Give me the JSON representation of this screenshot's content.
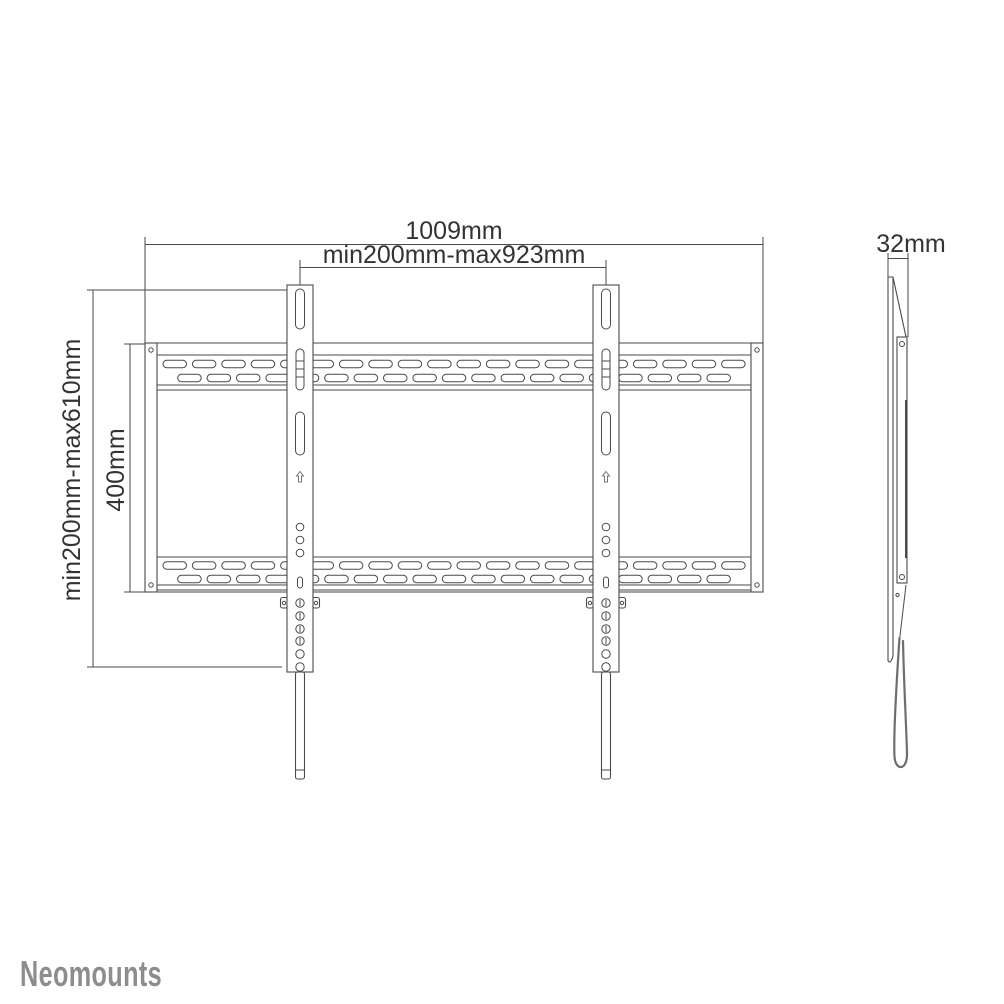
{
  "page": {
    "background": "#ffffff"
  },
  "brand": {
    "logo_text": "Neomounts",
    "logo_color": "#8d8d8d"
  },
  "front_view": {
    "dim_width_total": "1009mm",
    "dim_width_vesa_range": "min200mm-max923mm",
    "dim_height_vesa_range": "min200mm-max610mm",
    "dim_height_plate": "400mm"
  },
  "side_view": {
    "dim_depth": "32mm"
  },
  "drawing": {
    "line_color": "#4a4a4a",
    "dim_color": "#4a4a4a",
    "text_color": "#333333",
    "strap_color": "#6e6e6e"
  }
}
